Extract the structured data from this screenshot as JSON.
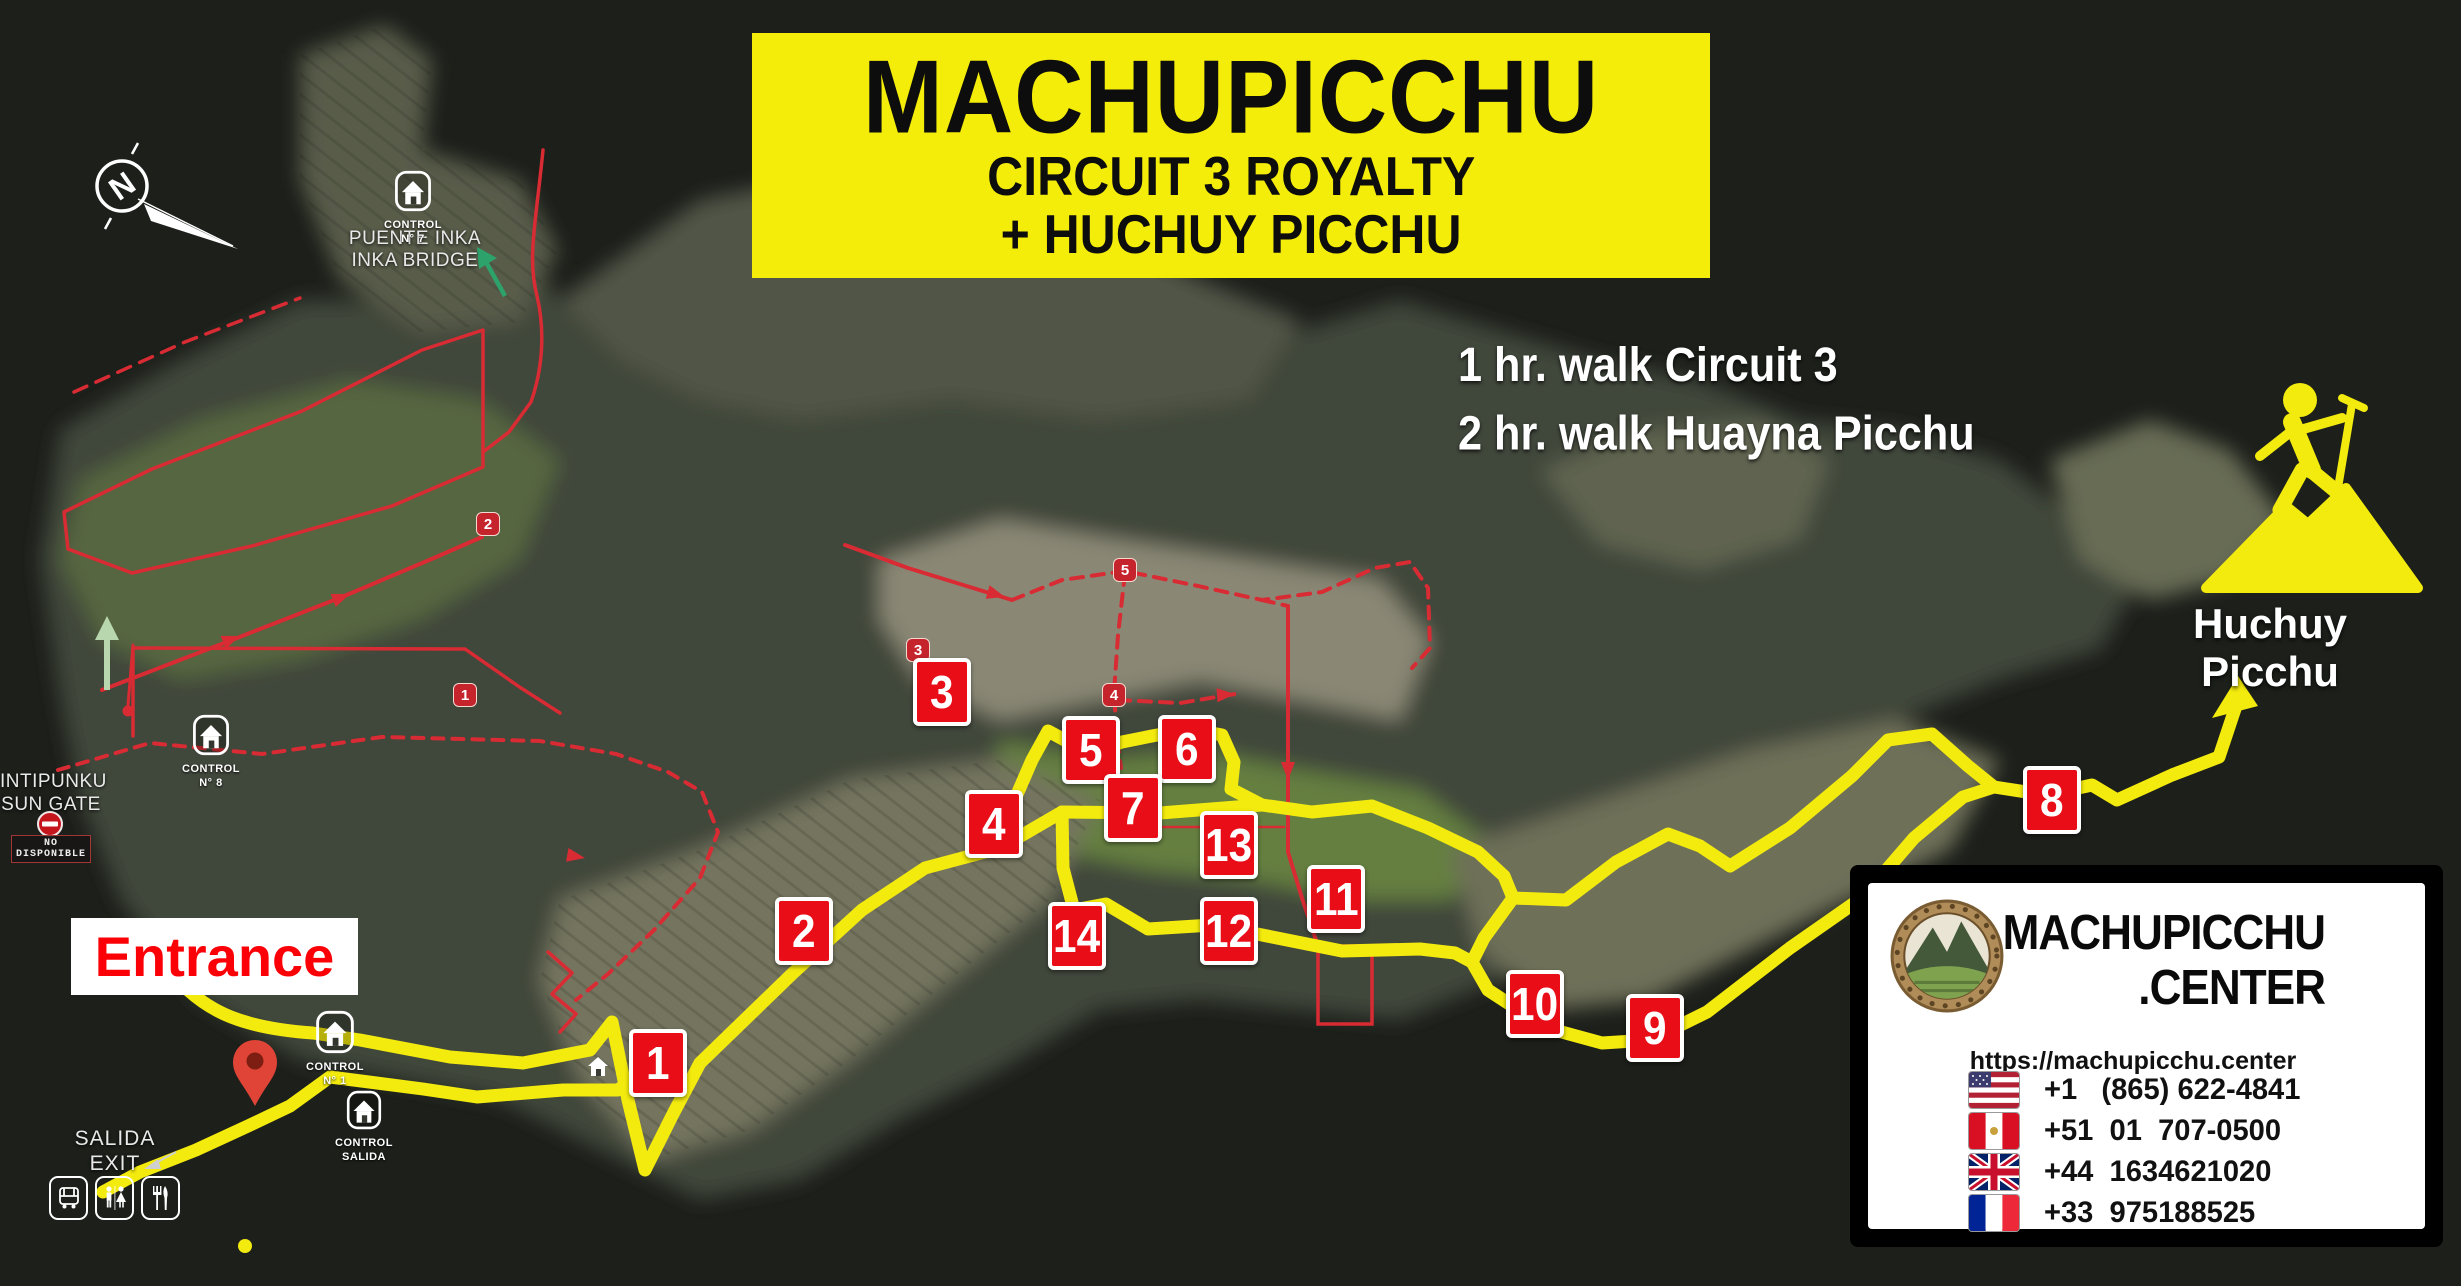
{
  "banner": {
    "line1": "MACHUPICCHU",
    "line2": "CIRCUIT 3 ROYALTY",
    "line3": "+ HUCHUY PICCHU"
  },
  "walk_info": {
    "line1": "1 hr. walk Circuit 3",
    "line2": "2 hr. walk Huayna Picchu"
  },
  "huchuy": {
    "label": "Huchuy Picchu"
  },
  "entrance": {
    "label": "Entrance"
  },
  "salida": {
    "line1": "SALIDA",
    "line2": "EXIT",
    "icons": [
      "bus",
      "restroom",
      "restaurant"
    ]
  },
  "intipunku": {
    "line1": "INTIPUNKU",
    "line2": "SUN GATE",
    "badge": "NO DISPONIBLE"
  },
  "puente_inka": {
    "line1": "PUENTE INKA",
    "line2": "INKA BRIDGE"
  },
  "compass": {
    "label": "N"
  },
  "controls": [
    {
      "id": "control-7",
      "line1": "CONTROL",
      "line2": "N° 7",
      "x": 413,
      "y": 170,
      "size": 38
    },
    {
      "id": "control-8",
      "line1": "CONTROL",
      "line2": "N° 8",
      "x": 211,
      "y": 714,
      "size": 38
    },
    {
      "id": "control-1",
      "line1": "CONTROL",
      "line2": "N° 1",
      "x": 335,
      "y": 1010,
      "size": 40
    },
    {
      "id": "control-salida",
      "line1": "CONTROL",
      "line2": "SALIDA",
      "x": 364,
      "y": 1090,
      "size": 36
    }
  ],
  "route_markers": [
    {
      "n": "1",
      "x": 658,
      "y": 1063
    },
    {
      "n": "2",
      "x": 804,
      "y": 931
    },
    {
      "n": "3",
      "x": 942,
      "y": 692
    },
    {
      "n": "4",
      "x": 994,
      "y": 824
    },
    {
      "n": "5",
      "x": 1091,
      "y": 750
    },
    {
      "n": "6",
      "x": 1187,
      "y": 749
    },
    {
      "n": "7",
      "x": 1133,
      "y": 808
    },
    {
      "n": "8",
      "x": 2052,
      "y": 800
    },
    {
      "n": "9",
      "x": 1655,
      "y": 1028
    },
    {
      "n": "10",
      "x": 1535,
      "y": 1004
    },
    {
      "n": "11",
      "x": 1336,
      "y": 899
    },
    {
      "n": "12",
      "x": 1229,
      "y": 931
    },
    {
      "n": "13",
      "x": 1229,
      "y": 845
    },
    {
      "n": "14",
      "x": 1077,
      "y": 936
    }
  ],
  "mini_markers": [
    {
      "n": "1",
      "x": 465,
      "y": 695
    },
    {
      "n": "2",
      "x": 488,
      "y": 524
    },
    {
      "n": "3",
      "x": 918,
      "y": 650
    },
    {
      "n": "4",
      "x": 1114,
      "y": 695
    },
    {
      "n": "5",
      "x": 1125,
      "y": 570
    }
  ],
  "info_box": {
    "brand_line1": "MACHUPICCHU",
    "brand_line2": ".CENTER",
    "website": "https://machupicchu.center",
    "phones": [
      {
        "flag": "us",
        "number": "+1   (865) 622-4841"
      },
      {
        "flag": "pe",
        "number": "+51  01  707-0500"
      },
      {
        "flag": "uk",
        "number": "+44  1634621020"
      },
      {
        "flag": "fr",
        "number": "+33  975188525"
      }
    ]
  },
  "colors": {
    "route_yellow": "#f4eb0e",
    "marker_red": "#e90d18",
    "banner_yellow": "#f4ec09",
    "entrance_red": "#fb0006"
  }
}
